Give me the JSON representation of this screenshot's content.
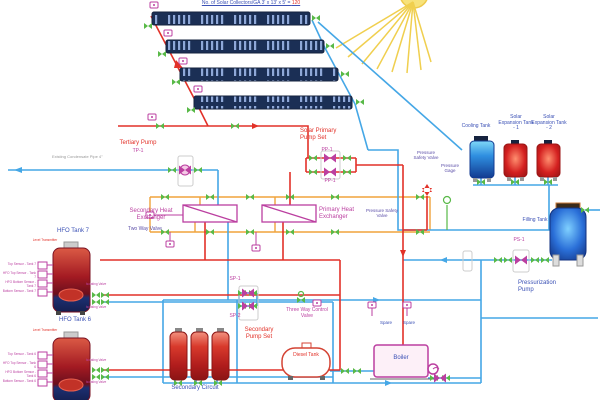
{
  "title": {
    "text": "No. of Solar Collectors/GA 3' x 13' x 5' =",
    "value": "120"
  },
  "colors": {
    "pipe_hot": "#e23128",
    "pipe_cold": "#45a7e6",
    "pipe_secondary": "#f0a33c",
    "valve_green": "#58b947",
    "component_magenta": "#bb3fa0",
    "label_blue": "#3a50b5",
    "collector_navy": "#1b2f55",
    "sun_yellow": "#f0cf4f"
  },
  "solar": {
    "tertiary_pump": "Tertiary Pump",
    "tertiary_pump_id": "TP-1",
    "existing_pipe": "Existing Condensate Pipe 4\"",
    "pump_set": "Solar Primary Pump Set",
    "pp1": "PP-1",
    "pp2": "PP-1",
    "pressure_safety_valve": "Pressure Safety Valve",
    "pressure_gage": "Pressure Gage",
    "pressure_safety_valve2": "Pressure Safety Valve"
  },
  "hx": {
    "secondary": "Secondary Heat Exchanger",
    "primary": "Primary Heat Exchanger",
    "two_way_valve": "Two Way Valve"
  },
  "right": {
    "cooling_tank": "Cooling Tank",
    "expansion1": "Solar Expansion Tank - 1",
    "expansion2": "Solar Expansion Tank - 2",
    "filling_tank": "Filling Tank",
    "ps1": "PS-1",
    "pressurization_pump": "Pressurization Pump"
  },
  "hfo": {
    "tank7": "HFO Tank 7",
    "tank6": "HFO Tank 6",
    "level_transmitter": "Level Transmitter",
    "isolating_valve": "Isolating Valve",
    "tank7_sensors": [
      "Top Sensor - Tank 7",
      "HFO Top Sensor - Tank 7",
      "HFO Bottom Sensor - Tank 7",
      "Bottom Sensor - Tank 7"
    ],
    "tank6_sensors": [
      "Top Sensor - Tank 6",
      "HFO Top Sensor - Tank 6",
      "HFO Bottom Sensor - Tank 6",
      "Bottom Sensor - Tank 6"
    ]
  },
  "secondary": {
    "sp1": "SP-1",
    "sp2": "SP-2",
    "pump_set": "Secondary Pump Set",
    "three_way_valve": "Three Way Control Valve",
    "circuit": "Secondary Circuit",
    "diesel_tank": "Diesel Tank",
    "boiler": "Boiler",
    "spare": "Spare"
  }
}
